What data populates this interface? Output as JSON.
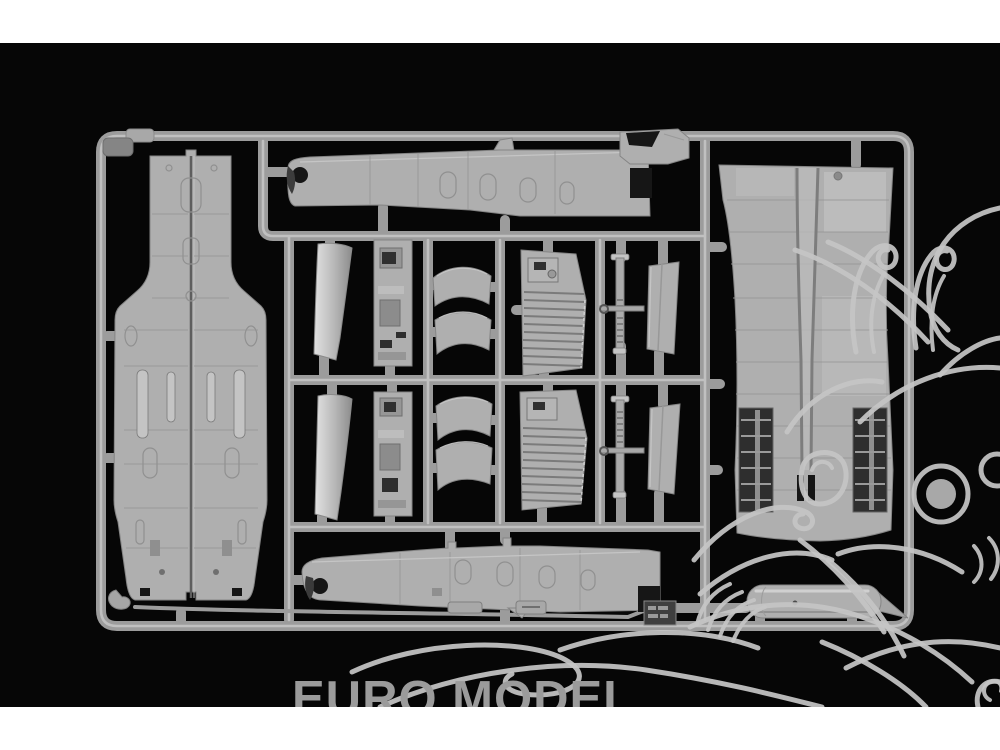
{
  "watermark": {
    "brand_text": "EURO MODEL"
  },
  "colors": {
    "page-bg": "#ffffff",
    "photo-bg": "#060606",
    "runner": "#9c9c9c",
    "runner-highlight": "#c9c9c9",
    "plastic": "#afafaf",
    "plastic-light": "#c4c4c4",
    "plastic-outline": "#858585",
    "cutout-dark": "#161616",
    "watermark-text": "#9b9b9b",
    "mascot-line": "#c5c5c5"
  }
}
